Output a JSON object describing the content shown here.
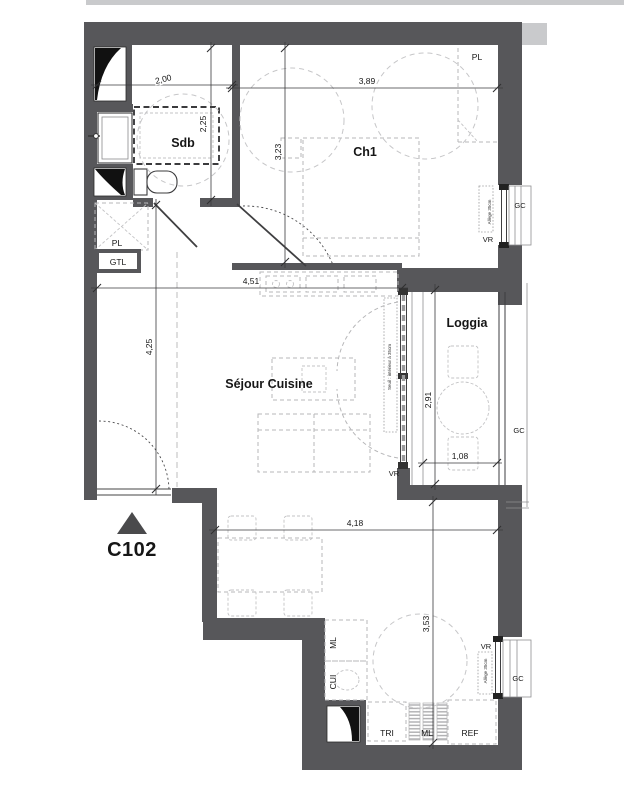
{
  "unit": {
    "label": "C102"
  },
  "rooms": {
    "sdb": "Sdb",
    "ch1": "Ch1",
    "sejour_cuisine": "Séjour Cuisine",
    "loggia": "Loggia"
  },
  "dims": {
    "sdb_width": "2,00",
    "sdb_height": "2,25",
    "ch1_height": "3,23",
    "ch1_width": "3,89",
    "sejour_width": "4,51",
    "hall_height": "4,25",
    "loggia_height": "2,91",
    "loggia_width": "1,08",
    "kitchen_width": "4,18",
    "kitchen_height": "3,53"
  },
  "labels": {
    "pl_hall": "PL",
    "gtl": "GTL",
    "pl_ch1": "PL",
    "vr_ch1": "VR",
    "gc_ch1": "GC",
    "vr_sejour": "VR",
    "gc_loggia": "GC",
    "vr_kitchen": "VR",
    "gc_kitchen": "GC",
    "ml_upper": "ML",
    "cui": "CUI",
    "tri": "TRI",
    "ml_lower": "ML",
    "ref": "REF",
    "seuil_note": "Seuil : intérieur à 35cm",
    "allege_ch1": "Allège 35cm",
    "allege_kitchen": "Allège 35cm"
  },
  "colors": {
    "wall": "#57575a",
    "dimension_line": "#3a3a3c",
    "furniture": "#b7b7b9",
    "text": "#161616"
  }
}
